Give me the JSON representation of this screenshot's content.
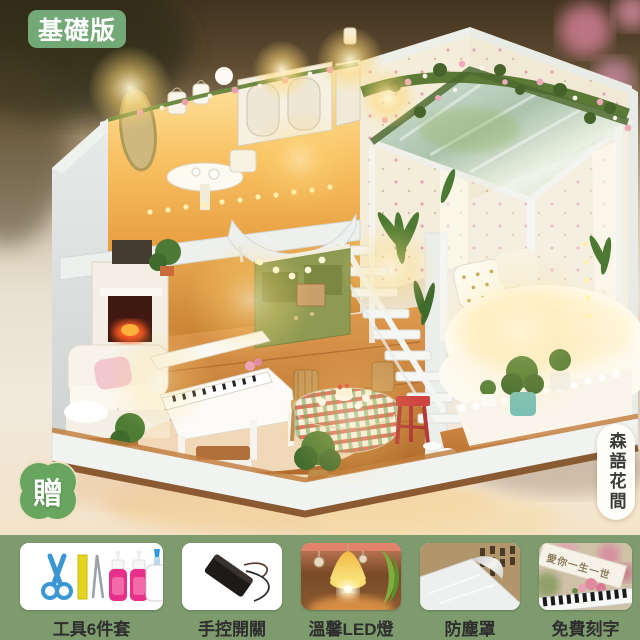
{
  "version_badge": {
    "label": "基礎版"
  },
  "gift_badge": {
    "label": "贈"
  },
  "product_pill": {
    "name": "森語花間"
  },
  "features": [
    {
      "label": "工具6件套",
      "icon": "tool-kit-photo"
    },
    {
      "label": "手控開關",
      "icon": "battery-switch-photo"
    },
    {
      "label": "溫馨LED燈",
      "icon": "led-lamp-photo"
    },
    {
      "label": "防塵罩",
      "icon": "dust-cover-photo"
    },
    {
      "label": "免費刻字",
      "icon": "engraving-photo"
    }
  ],
  "feature_photos": {
    "engraving_text": "愛你一生一世"
  },
  "colors": {
    "strip_green": "#7e9b6e",
    "version_badge_green": "#73a877",
    "gift_badge_green": "#68a65f",
    "gift_badge_border": "#ecdfc0",
    "label_text": "#2e2e2e",
    "pill_text": "#3a3a3a",
    "warm_glow": "#ffd978",
    "wood_floor": "#cf8a3e",
    "kitchen_green": "#8e9a52"
  }
}
